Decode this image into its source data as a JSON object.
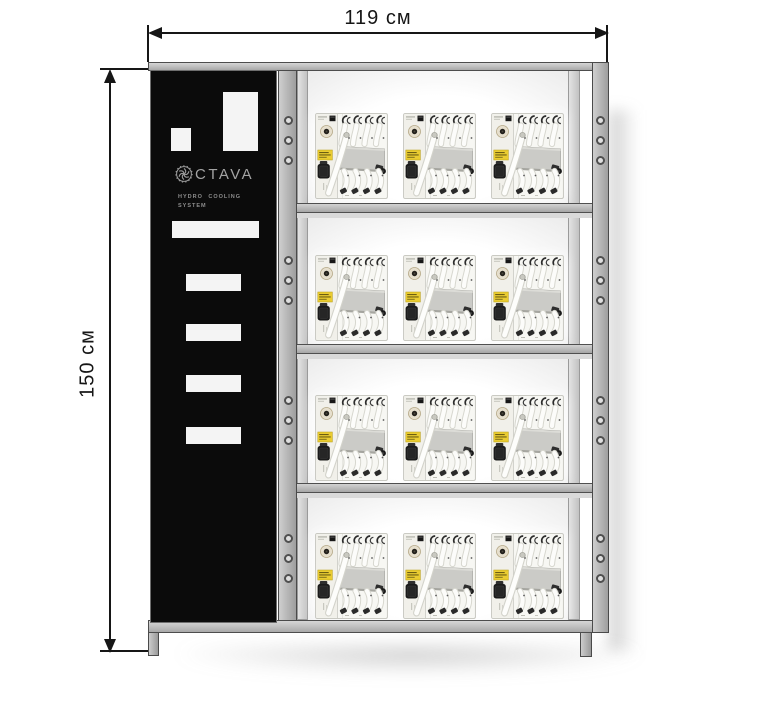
{
  "dimensions": {
    "width_label": "119 см",
    "height_label": "150 см"
  },
  "branding": {
    "logo_icon": "impeller-gear-icon",
    "logo_text": "CTAVA",
    "tagline_line1": "HYDRO COOLING",
    "tagline_line2": "SYSTEM"
  },
  "rack": {
    "shelves": 4,
    "units_per_shelf": 3,
    "mounting_holes_per_bay": 3,
    "posts_with_holes": 2
  },
  "unit_features": [
    "network-port",
    "round-connector",
    "yellow-warning-label",
    "power-connector",
    "top-tube-clamps",
    "manifold-plate",
    "drain-tube",
    "bottom-tube-fittings"
  ],
  "colors": {
    "frame": "#b3b3b3",
    "frame_border": "#4d4d4d",
    "panel_bg": "#0b0b0b",
    "logo_gray": "#a3a3a3",
    "warning_label_yellow": "#eacc31",
    "dimension_ink": "#161616",
    "bay_glow": "#ffffff"
  }
}
